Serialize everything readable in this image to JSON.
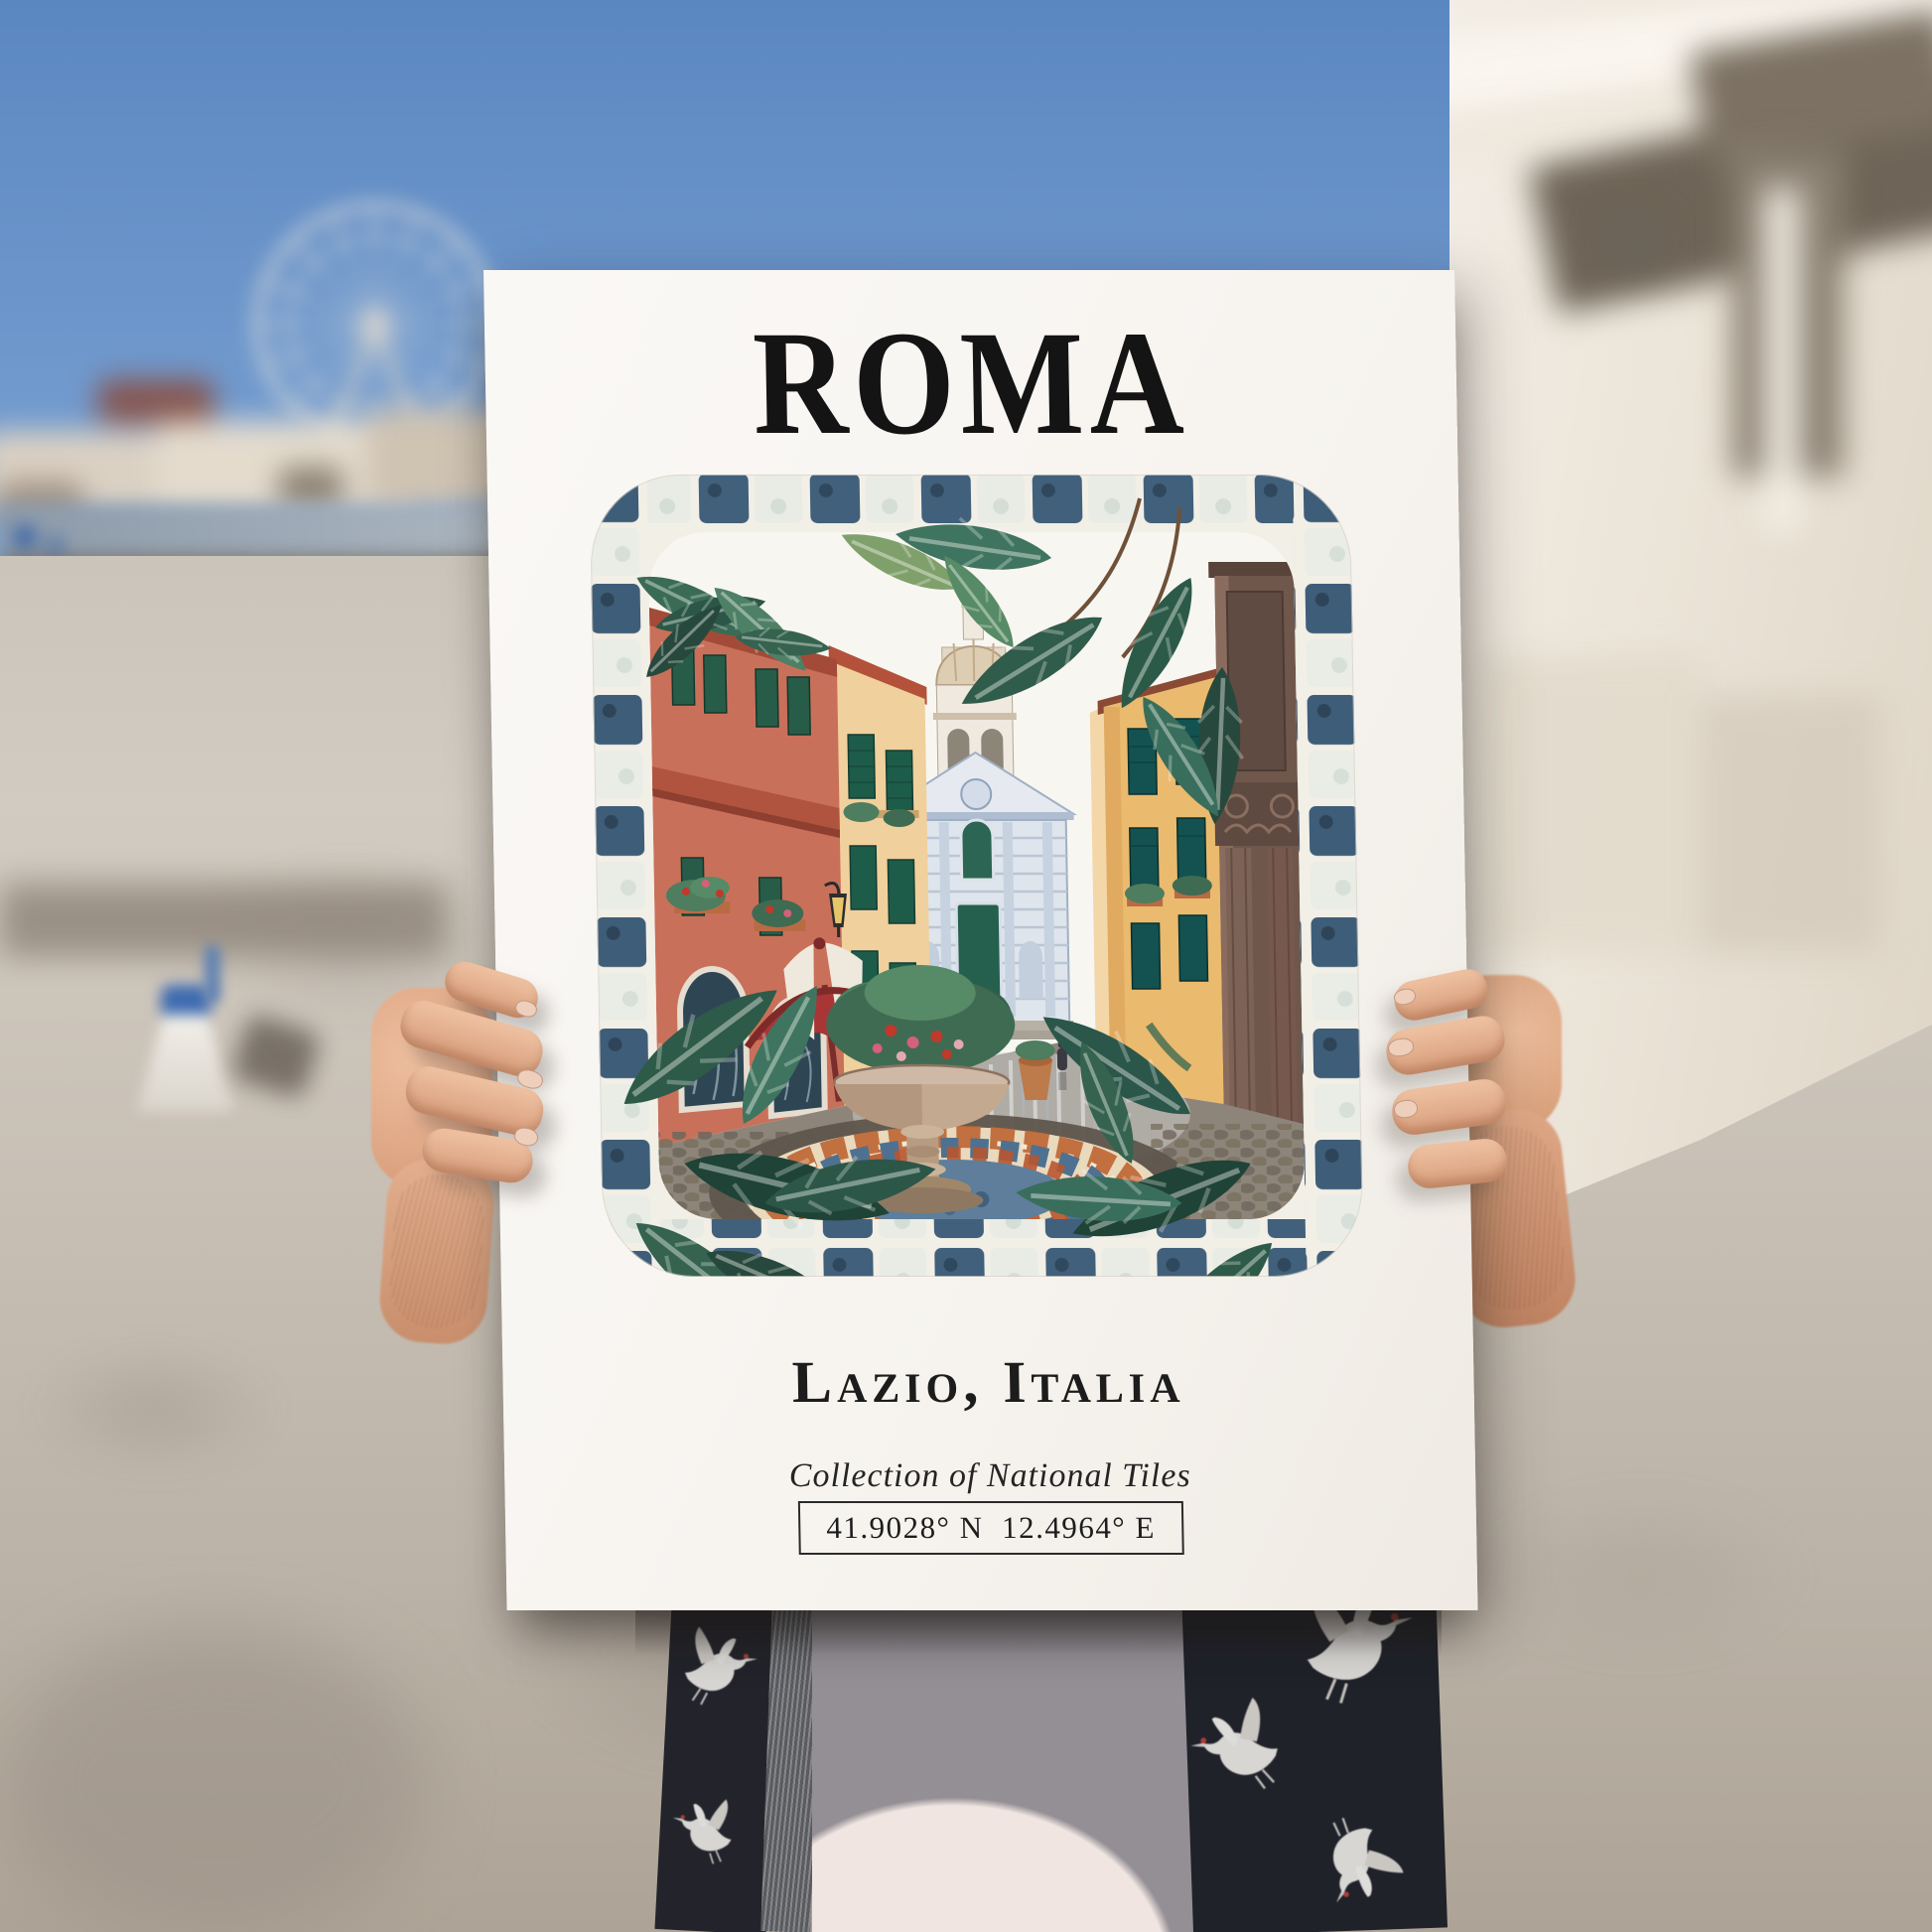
{
  "poster": {
    "title": "ROMA",
    "subtitle": "Lazio, Italia",
    "collection_line": "Collection of National Tiles",
    "coordinates": "41.9028° N  12.4964° E"
  },
  "palette": {
    "poster_paper": "#faf8f5",
    "ink": "#141414",
    "sky_top": "#5b87c1",
    "tile_slate": "#41607b",
    "tile_white": "#e9ece5",
    "terracotta": "#c9705a",
    "cream_wall": "#f0d09c",
    "ochre_wall": "#eaba6e",
    "shutter_green": "#275c49",
    "church_blue": "#dfe5ec",
    "umbrella_red": "#a83636",
    "leaf_dark": "#2c5748",
    "mosaic_blue": "#5e7e9b",
    "mosaic_orange": "#c06a38",
    "stone_column": "#6f574c",
    "shirt_black": "#23242b",
    "tee_white": "#f0e5e1",
    "skin": "#e5b193",
    "pavement": "#c8c0b5"
  }
}
